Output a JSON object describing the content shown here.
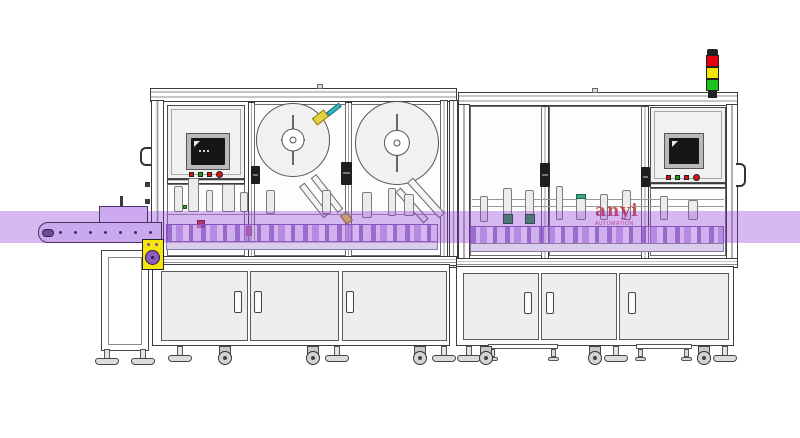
{
  "watermark": {
    "brand": "anyi",
    "subtitle": "AUTOMATION"
  },
  "colors": {
    "outline": "#3c3c3c",
    "highlight-band": "#8b2fd6",
    "conveyor-belt": "#c9a8ee",
    "motor-plate": "#f6e60a",
    "gear": "#8e5bbf",
    "panel-fill": "#f1f1f1",
    "door-fill": "#eeeeee",
    "screen": "#161616",
    "button-red": "#dd1111",
    "button-green": "#15a115",
    "tower-red": "#e8000b",
    "tower-yellow": "#f2e500",
    "tower-green": "#1ec41e",
    "gripper-green": "#2f9e44",
    "watermark-red": "#c23434"
  },
  "indicators": {
    "tower_lights": [
      "red",
      "yellow",
      "green"
    ],
    "hmi_buttons_left": [
      "red",
      "green",
      "red",
      "red-round"
    ],
    "hmi_buttons_right": [
      "red",
      "green",
      "red",
      "red-round"
    ]
  }
}
